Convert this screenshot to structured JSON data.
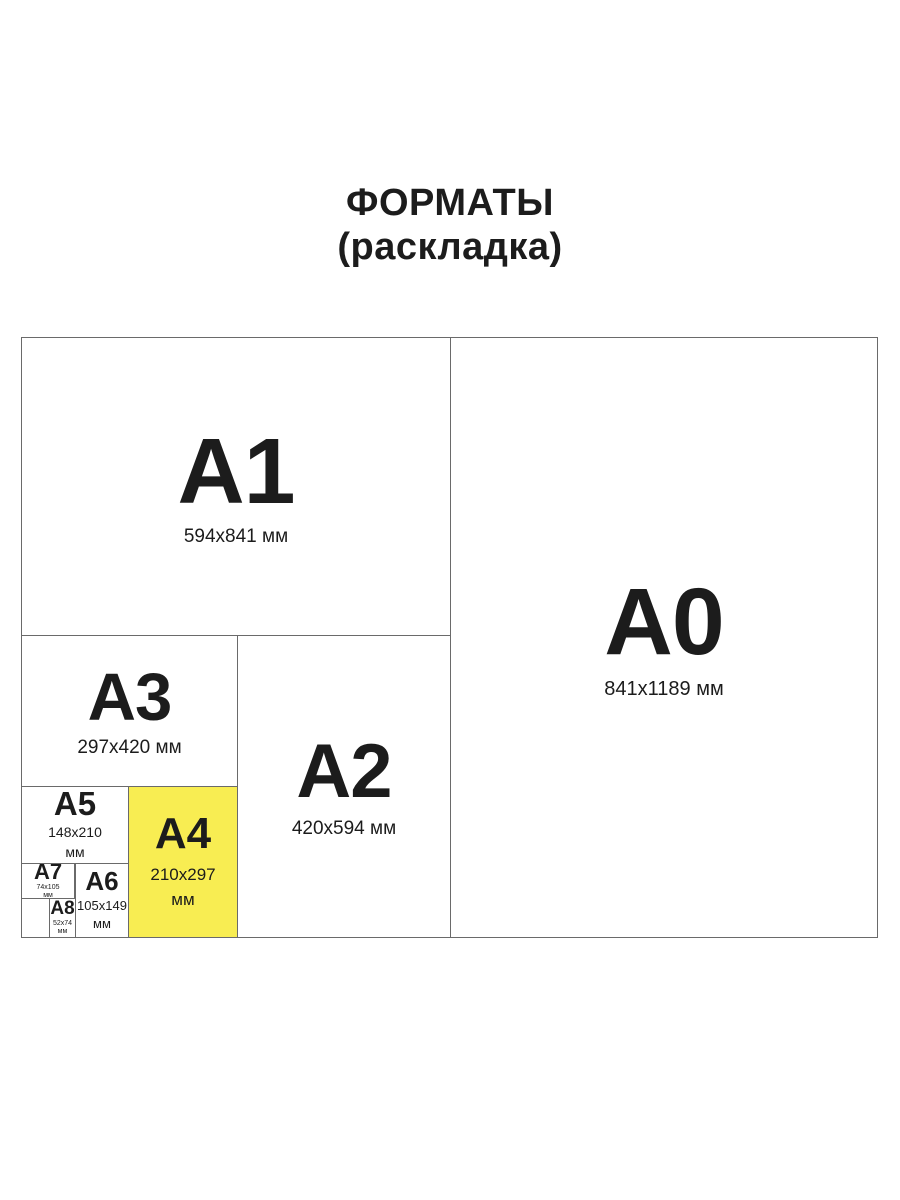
{
  "title": {
    "line1": "ФОРМАТЫ",
    "line2": "(раскладка)"
  },
  "colors": {
    "highlight": "#F8ED52",
    "line": "#6a6a6a",
    "text": "#1c1c1c",
    "background": "#ffffff"
  },
  "formats": {
    "a0": {
      "label": "A0",
      "dims": "841x1189 мм",
      "highlighted": false
    },
    "a1": {
      "label": "A1",
      "dims": "594x841 мм",
      "highlighted": false
    },
    "a2": {
      "label": "A2",
      "dims": "420x594 мм",
      "highlighted": false
    },
    "a3": {
      "label": "A3",
      "dims": "297x420 мм",
      "highlighted": false
    },
    "a4": {
      "label": "A4",
      "dims1": "210x297",
      "dims2": "мм",
      "highlighted": true
    },
    "a5": {
      "label": "A5",
      "dims1": "148x210",
      "dims2": "мм",
      "highlighted": false
    },
    "a6": {
      "label": "A6",
      "dims1": "105x149",
      "dims2": "мм",
      "highlighted": false
    },
    "a7": {
      "label": "A7",
      "dims1": "74x105",
      "dims2": "мм",
      "highlighted": false
    },
    "a8": {
      "label": "A8",
      "dims1": "52x74",
      "dims2": "мм",
      "highlighted": false
    }
  }
}
